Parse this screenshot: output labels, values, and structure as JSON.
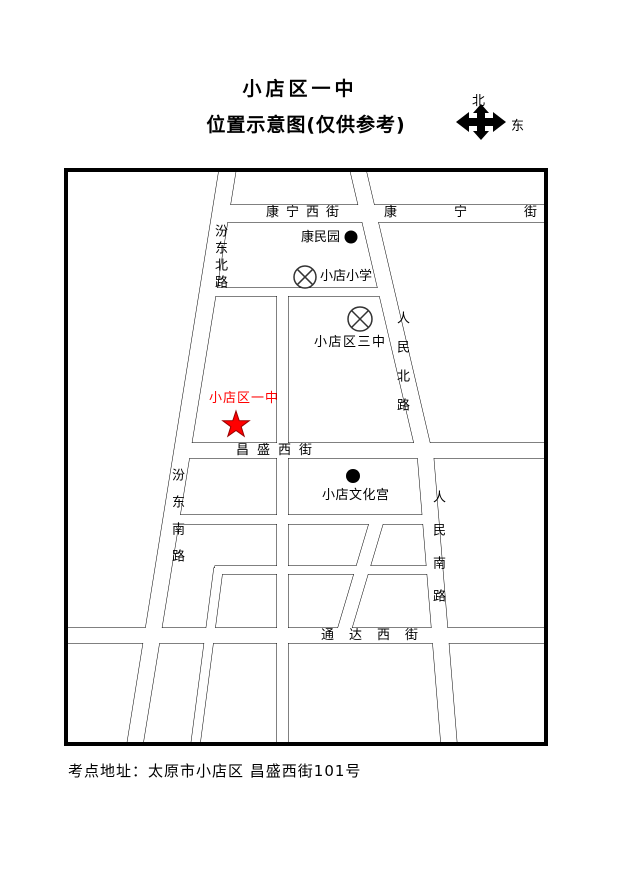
{
  "title": {
    "line1": "小店区一中",
    "line2": "位置示意图(仅供参考)"
  },
  "compass": {
    "north": "北",
    "east": "东"
  },
  "map": {
    "streets": {
      "kangning_west": "康宁西街",
      "kangning": "康宁街",
      "changsheng_west": "昌盛西街",
      "tongda_west": "通达西街",
      "fendong_north": "汾东北路",
      "fendong_south": "汾东南路",
      "renmin_north": "人民北路",
      "renmin_south": "人民南路"
    },
    "pois": {
      "kangminyuan": "康民园",
      "xiaodian_primary": "小店小学",
      "xiaodian_no3": "小店区三中",
      "xiaodian_no1": "小店区一中",
      "cultural_palace": "小店文化宫"
    },
    "symbols": {
      "school_marker": "circle-x-icon",
      "place_marker": "filled-dot-icon",
      "target_marker": "red-star-icon"
    }
  },
  "footer": {
    "address": "考点地址：太原市小店区 昌盛西街101号"
  },
  "colors": {
    "highlight_red": "#ff0000",
    "star_outline": "#990000",
    "ink": "#000000",
    "poi_symbol": "#333333"
  }
}
